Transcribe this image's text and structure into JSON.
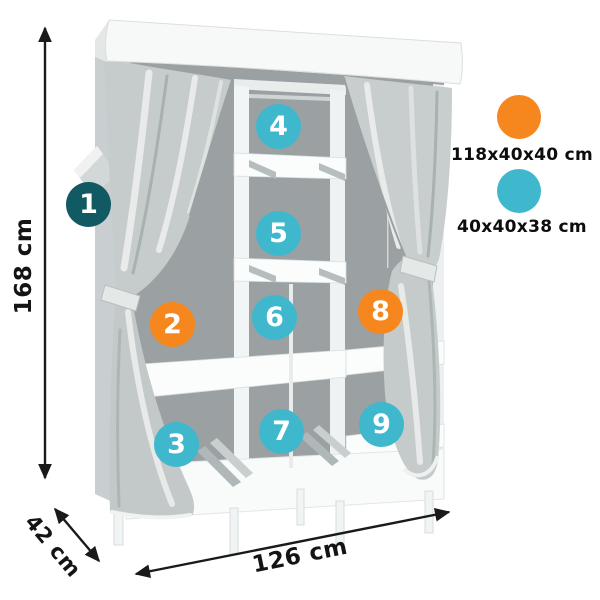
{
  "canvas": {
    "background": "#ffffff"
  },
  "dimensions": {
    "height": "168 cm",
    "depth": "42 cm",
    "width": "126 cm"
  },
  "badges": [
    {
      "number": "1",
      "color": "#115a64"
    },
    {
      "number": "2",
      "color": "#f6871e"
    },
    {
      "number": "3",
      "color": "#3fb8ce"
    },
    {
      "number": "4",
      "color": "#3fb8ce"
    },
    {
      "number": "5",
      "color": "#3fb8ce"
    },
    {
      "number": "6",
      "color": "#3fb8ce"
    },
    {
      "number": "7",
      "color": "#3fb8ce"
    },
    {
      "number": "8",
      "color": "#f6871e"
    },
    {
      "number": "9",
      "color": "#3fb8ce"
    }
  ],
  "legend": [
    {
      "label": "118x40x40 cm",
      "color": "#f6871e"
    },
    {
      "label": "40x40x38 cm",
      "color": "#3fb8ce"
    }
  ],
  "arrow_color": "#1a1a1a"
}
